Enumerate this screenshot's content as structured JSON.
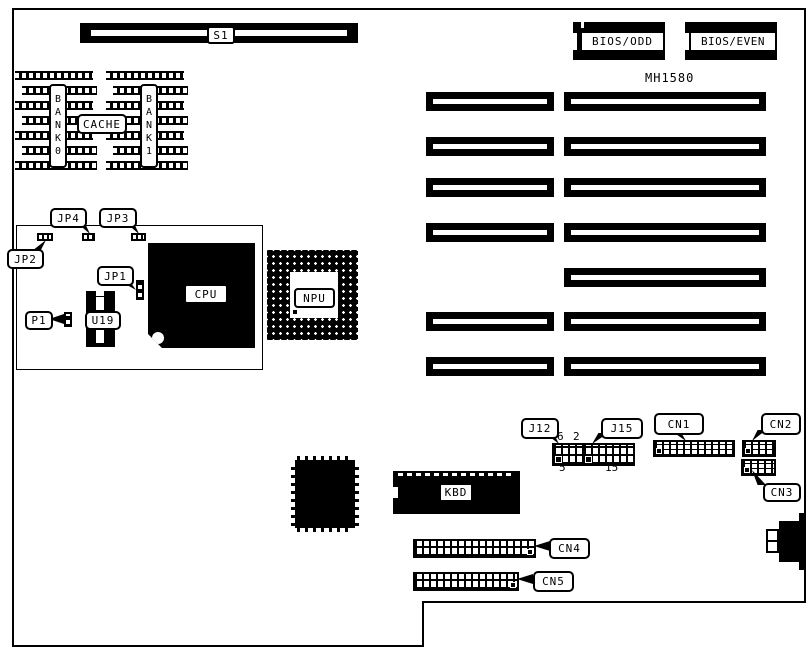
{
  "board": {
    "model": "MH1580",
    "colors": {
      "line": "#000000",
      "background": "#ffffff"
    }
  },
  "labels": {
    "s1": "S1",
    "bank0": "BANK0",
    "bank1": "BANK1",
    "cache": "CACHE",
    "jp1": "JP1",
    "jp2": "JP2",
    "jp3": "JP3",
    "jp4": "JP4",
    "p1": "P1",
    "u19": "U19",
    "cpu": "CPU",
    "npu": "NPU",
    "bios_odd": "BIOS/ODD",
    "bios_even": "BIOS/EVEN",
    "j12": "J12",
    "j15": "J15",
    "cn1": "CN1",
    "cn2": "CN2",
    "cn3": "CN3",
    "cn4": "CN4",
    "cn5": "CN5",
    "kbd": "KBD"
  },
  "pin_numbers": {
    "j12_top": "6",
    "j15_top": "2",
    "j12_bottom": "5",
    "j15_bottom": "15"
  }
}
